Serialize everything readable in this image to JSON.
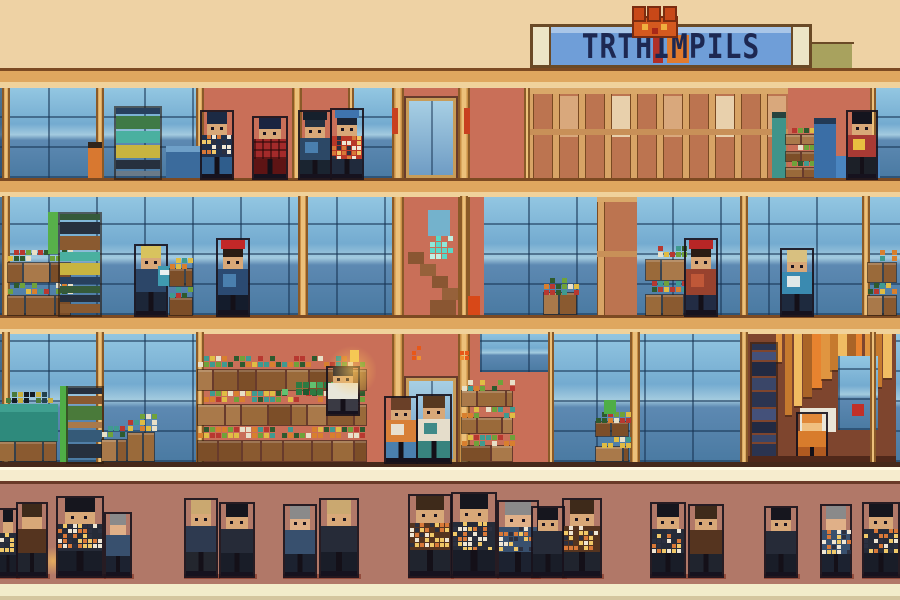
{
  "sign": {
    "text": "TRTHIMPILS"
  },
  "palette": {
    "sky": "#eed2a4",
    "wall": "#c96f58",
    "street": "#b17868",
    "sidewalk": "#f6ecce",
    "beamLine": "#7c4a22",
    "beamBody": "#dfa75f",
    "beamHi": "#f0d29b",
    "goldDark": "#8a5a28",
    "gold": "#c98f46",
    "goldHi": "#ecc07a",
    "glassLine": "rgba(23,52,84,0.55)",
    "shopBg": "#7e452e",
    "woodBase": "#bc7450",
    "signFrame": "#bd8b51",
    "signCap": "#ece5c6",
    "signBlue": "#6f9ed8",
    "signText": "#1d2852",
    "outline": "rgba(24,18,28,0.9)",
    "shadow": "rgba(122,40,24,0.55)"
  },
  "crowdPalettes": [
    {
      "hair": "#16161e",
      "skin": "#d8a878",
      "body": "#262b38",
      "legs": "#191d28"
    },
    {
      "hair": "#3e2a1a",
      "skin": "#d8a878",
      "body": "#55341f",
      "legs": "#20242e"
    },
    {
      "hair": "#8a8a8a",
      "skin": "#e0b088",
      "body": "#38506e",
      "legs": "#1c2230"
    },
    {
      "hair": "#caa870",
      "skin": "#d8a878",
      "body": "#2e3a50",
      "legs": "#23262e"
    }
  ],
  "crowd": [
    {
      "x": 0,
      "w": 16,
      "h": 66,
      "v": 0,
      "lit": 1
    },
    {
      "x": 18,
      "w": 28,
      "h": 72,
      "v": 1
    },
    {
      "x": 58,
      "w": 44,
      "h": 78,
      "v": 0,
      "lit": 1
    },
    {
      "x": 106,
      "w": 24,
      "h": 62,
      "v": 2
    },
    {
      "x": 186,
      "w": 30,
      "h": 76,
      "v": 3
    },
    {
      "x": 221,
      "w": 32,
      "h": 72,
      "v": 0
    },
    {
      "x": 285,
      "w": 30,
      "h": 70,
      "v": 2
    },
    {
      "x": 321,
      "w": 36,
      "h": 76,
      "v": 0,
      "hat": 1
    },
    {
      "x": 410,
      "w": 40,
      "h": 80,
      "v": 1,
      "lit": 1
    },
    {
      "x": 453,
      "w": 42,
      "h": 82,
      "v": 0,
      "lit": 1
    },
    {
      "x": 499,
      "w": 38,
      "h": 74,
      "v": 2,
      "lit": 1
    },
    {
      "x": 533,
      "w": 30,
      "h": 68,
      "v": 0
    },
    {
      "x": 564,
      "w": 36,
      "h": 76,
      "v": 1,
      "lit": 1
    },
    {
      "x": 652,
      "w": 32,
      "h": 72,
      "v": 0,
      "lit": 1
    },
    {
      "x": 690,
      "w": 32,
      "h": 70,
      "v": 1
    },
    {
      "x": 766,
      "w": 30,
      "h": 68,
      "v": 0
    },
    {
      "x": 822,
      "w": 28,
      "h": 70,
      "v": 2,
      "lit": 1
    },
    {
      "x": 864,
      "w": 34,
      "h": 72,
      "v": 0,
      "lit": 1
    }
  ],
  "layers": [
    {
      "k": "rect",
      "x": 745,
      "y": 42,
      "w": 109,
      "h": 2,
      "c": "#6a4a26"
    },
    {
      "k": "rect",
      "x": 747,
      "y": 44,
      "w": 48,
      "h": 24,
      "c": "#d9b069"
    },
    {
      "k": "rect",
      "x": 795,
      "y": 44,
      "w": 57,
      "h": 24,
      "c": "#a8a25e"
    },
    {
      "k": "rect",
      "x": 0,
      "y": 88,
      "w": 900,
      "h": 374,
      "c": "wall"
    },
    {
      "k": "glass",
      "x": 0,
      "y": 88,
      "w": 204,
      "h": 90
    },
    {
      "k": "glass",
      "x": 350,
      "y": 88,
      "w": 46,
      "h": 90
    },
    {
      "k": "glass",
      "x": 874,
      "y": 88,
      "w": 26,
      "h": 90
    },
    {
      "k": "glass",
      "x": 0,
      "y": 196,
      "w": 900,
      "h": 119
    },
    {
      "k": "glass",
      "x": 0,
      "y": 332,
      "w": 204,
      "h": 130
    },
    {
      "k": "glass",
      "x": 548,
      "y": 332,
      "w": 200,
      "h": 130
    },
    {
      "k": "glass",
      "x": 874,
      "y": 332,
      "w": 26,
      "h": 130
    },
    {
      "k": "glass",
      "x": 480,
      "y": 332,
      "w": 68,
      "h": 40
    },
    {
      "k": "rect",
      "x": 468,
      "y": 196,
      "w": 16,
      "h": 119,
      "c": "wall"
    },
    {
      "k": "wood",
      "x": 597,
      "y": 196,
      "w": 40,
      "h": 119
    },
    {
      "k": "wood",
      "x": 526,
      "y": 88,
      "w": 262,
      "h": 90
    },
    {
      "k": "rect",
      "x": 748,
      "y": 332,
      "w": 148,
      "h": 130,
      "c": "shopBg"
    },
    {
      "k": "strips",
      "x": 776,
      "y": 334,
      "w": 116,
      "h": 96,
      "n": 13
    },
    {
      "k": "stack",
      "x": 752,
      "y": 344,
      "w": 24,
      "h": 118,
      "pal": [
        "#2b3450",
        "#44517a",
        "#222a42",
        "#3a4668"
      ],
      "seed": 3
    },
    {
      "k": "rect",
      "x": 800,
      "y": 408,
      "w": 36,
      "h": 24,
      "c": "#eae6d8"
    },
    {
      "k": "glass",
      "x": 838,
      "y": 356,
      "w": 40,
      "h": 74
    },
    {
      "k": "rect",
      "x": 852,
      "y": 404,
      "w": 12,
      "h": 12,
      "c": "#c23028"
    },
    {
      "k": "person",
      "x": 798,
      "y": 414,
      "w": 28,
      "h": 48,
      "hair": "#e08838",
      "skin": "#f0c080",
      "body": "#d87c2c",
      "legs": "#b05a20"
    },
    {
      "k": "rect",
      "x": 748,
      "y": 456,
      "w": 148,
      "h": 6,
      "c": "#50281a"
    },
    {
      "k": "rect",
      "x": 404,
      "y": 88,
      "w": 54,
      "h": 374,
      "c": "wall"
    },
    {
      "k": "col",
      "x": 392,
      "y": 88,
      "w": 12,
      "h": 374
    },
    {
      "k": "col",
      "x": 458,
      "y": 88,
      "w": 12,
      "h": 374
    },
    {
      "k": "rect",
      "x": 392,
      "y": 108,
      "w": 6,
      "h": 26,
      "c": "#c84020"
    },
    {
      "k": "rect",
      "x": 464,
      "y": 108,
      "w": 6,
      "h": 26,
      "c": "#c84020"
    },
    {
      "k": "door",
      "x": 406,
      "y": 98,
      "w": 50,
      "h": 80
    },
    {
      "k": "rect",
      "x": 428,
      "y": 210,
      "w": 22,
      "h": 26,
      "c": "#74b2cc"
    },
    {
      "k": "pixels",
      "x": 430,
      "y": 236,
      "w": 22,
      "h": 26,
      "pal": [
        "#5ad8c8",
        "#bff0e2",
        "#2a8a7a",
        "#8ee8d8"
      ],
      "seed": 7,
      "sz": 6
    },
    {
      "k": "rect",
      "x": 408,
      "y": 252,
      "w": 16,
      "h": 12,
      "c": "#8a5632"
    },
    {
      "k": "rect",
      "x": 420,
      "y": 264,
      "w": 16,
      "h": 12,
      "c": "#96613a"
    },
    {
      "k": "rect",
      "x": 432,
      "y": 276,
      "w": 16,
      "h": 12,
      "c": "#8a5632"
    },
    {
      "k": "rect",
      "x": 442,
      "y": 288,
      "w": 16,
      "h": 12,
      "c": "#96613a"
    },
    {
      "k": "rect",
      "x": 430,
      "y": 300,
      "w": 26,
      "h": 15,
      "c": "#8a5632"
    },
    {
      "k": "door",
      "x": 406,
      "y": 378,
      "w": 50,
      "h": 84
    },
    {
      "k": "pixels",
      "x": 412,
      "y": 346,
      "w": 10,
      "h": 16,
      "pal": [
        "#f09030",
        "#e85818",
        "#f8c040"
      ],
      "seed": 11,
      "sz": 5
    },
    {
      "k": "pixels",
      "x": 460,
      "y": 346,
      "w": 10,
      "h": 16,
      "pal": [
        "#f09030",
        "#e85818",
        "#f8c040"
      ],
      "seed": 13,
      "sz": 5
    },
    {
      "k": "beam",
      "y": 68
    },
    {
      "k": "beam",
      "y": 178
    },
    {
      "k": "beam",
      "y": 315
    },
    {
      "k": "rect",
      "x": 0,
      "y": 462,
      "w": 900,
      "h": 5,
      "c": "#46291b"
    },
    {
      "k": "col",
      "x": 2,
      "y": 88,
      "w": 8,
      "h": 90
    },
    {
      "k": "col",
      "x": 96,
      "y": 88,
      "w": 8,
      "h": 90
    },
    {
      "k": "col",
      "x": 196,
      "y": 88,
      "w": 8,
      "h": 90
    },
    {
      "k": "col",
      "x": 292,
      "y": 88,
      "w": 10,
      "h": 90
    },
    {
      "k": "col",
      "x": 348,
      "y": 88,
      "w": 6,
      "h": 90
    },
    {
      "k": "col",
      "x": 524,
      "y": 88,
      "w": 6,
      "h": 90
    },
    {
      "k": "col",
      "x": 870,
      "y": 88,
      "w": 6,
      "h": 90
    },
    {
      "k": "col",
      "x": 2,
      "y": 196,
      "w": 8,
      "h": 119
    },
    {
      "k": "col",
      "x": 298,
      "y": 196,
      "w": 10,
      "h": 119
    },
    {
      "k": "col",
      "x": 460,
      "y": 196,
      "w": 8,
      "h": 119
    },
    {
      "k": "col",
      "x": 740,
      "y": 196,
      "w": 8,
      "h": 119
    },
    {
      "k": "col",
      "x": 862,
      "y": 196,
      "w": 8,
      "h": 119
    },
    {
      "k": "col",
      "x": 2,
      "y": 332,
      "w": 8,
      "h": 130
    },
    {
      "k": "col",
      "x": 96,
      "y": 332,
      "w": 8,
      "h": 130
    },
    {
      "k": "col",
      "x": 196,
      "y": 332,
      "w": 8,
      "h": 130
    },
    {
      "k": "col",
      "x": 548,
      "y": 332,
      "w": 6,
      "h": 130
    },
    {
      "k": "col",
      "x": 630,
      "y": 332,
      "w": 10,
      "h": 130
    },
    {
      "k": "col",
      "x": 740,
      "y": 332,
      "w": 8,
      "h": 130
    },
    {
      "k": "col",
      "x": 870,
      "y": 332,
      "w": 6,
      "h": 130
    },
    {
      "k": "stack",
      "x": 116,
      "y": 108,
      "w": 44,
      "h": 70,
      "pal": [
        "#27405e",
        "#3f7a46",
        "#4ab0a0",
        "#c8b440",
        "#26303e",
        "#6a7a88",
        "#355a78"
      ],
      "seed": 21
    },
    {
      "k": "rect",
      "x": 88,
      "y": 142,
      "w": 14,
      "h": 6,
      "c": "#30241c"
    },
    {
      "k": "rect",
      "x": 88,
      "y": 148,
      "w": 14,
      "h": 30,
      "c": "#d87830"
    },
    {
      "k": "rect",
      "x": 166,
      "y": 146,
      "w": 38,
      "h": 6,
      "c": "#6fa0c8"
    },
    {
      "k": "rect",
      "x": 166,
      "y": 152,
      "w": 38,
      "h": 26,
      "c": "#3b6b9c"
    },
    {
      "k": "person",
      "x": 202,
      "y": 112,
      "w": 30,
      "h": 66,
      "hair": "#1c2a44",
      "skin": "#d8a878",
      "body": "#20304c",
      "legs": "#2f5d8c",
      "lit": 1,
      "eyes": 1
    },
    {
      "k": "person",
      "x": 254,
      "y": 118,
      "w": 32,
      "h": 60,
      "hair": "#1a2440",
      "skin": "#d8a878",
      "body": "#a32a2a",
      "legs": "#5e1414",
      "plaid": 1,
      "eyes": 1
    },
    {
      "k": "person",
      "x": 300,
      "y": 112,
      "w": 30,
      "h": 66,
      "hat": "#16202c",
      "hair": "#222f40",
      "skin": "#d8a878",
      "body": "#2c4866",
      "legs": "#1a2430",
      "patch": "#4a7fae",
      "eyes": 1
    },
    {
      "k": "person",
      "x": 332,
      "y": 110,
      "w": 30,
      "h": 68,
      "hat": "#3f74ae",
      "hair": "#1c2434",
      "skin": "#d8a878",
      "body": "#b83828",
      "legs": "#202a3c",
      "lit": 1,
      "eyes": 1
    },
    {
      "k": "rect",
      "x": 772,
      "y": 112,
      "w": 14,
      "h": 6,
      "c": "#26433e"
    },
    {
      "k": "rect",
      "x": 772,
      "y": 118,
      "w": 14,
      "h": 60,
      "c": "#3f948a"
    },
    {
      "k": "crates",
      "x": 786,
      "y": 128,
      "w": 30,
      "h": 50,
      "rows": 3,
      "seed": 31
    },
    {
      "k": "rect",
      "x": 814,
      "y": 118,
      "w": 22,
      "h": 6,
      "c": "#223a56"
    },
    {
      "k": "rect",
      "x": 814,
      "y": 124,
      "w": 22,
      "h": 54,
      "c": "#3a6ea6"
    },
    {
      "k": "rect",
      "x": 836,
      "y": 156,
      "w": 44,
      "h": 22,
      "c": "#4a85c0"
    },
    {
      "k": "person",
      "x": 848,
      "y": 112,
      "w": 28,
      "h": 66,
      "hair": "#14141e",
      "skin": "#d8a878",
      "body": "#a83a34",
      "legs": "#1c2028",
      "patch": "#e8c040",
      "eyes": 1
    },
    {
      "k": "crates",
      "x": 8,
      "y": 250,
      "w": 64,
      "h": 65,
      "rows": 2,
      "seed": 41
    },
    {
      "k": "rect",
      "x": 48,
      "y": 212,
      "w": 10,
      "h": 42,
      "c": "#57b04a"
    },
    {
      "k": "stack",
      "x": 60,
      "y": 214,
      "w": 40,
      "h": 101,
      "pal": [
        "#355a3a",
        "#26303e",
        "#8a5a30",
        "#4ab0a0",
        "#c8b440",
        "#27405e"
      ],
      "seed": 43
    },
    {
      "k": "person",
      "x": 136,
      "y": 246,
      "w": 30,
      "h": 69,
      "hair": "#d8c35e",
      "skin": "#d8a878",
      "body": "#2c4668",
      "legs": "#1c2638",
      "eyes": 1
    },
    {
      "k": "rect",
      "x": 158,
      "y": 266,
      "w": 16,
      "h": 20,
      "c": "#3f9ab0"
    },
    {
      "k": "rect",
      "x": 160,
      "y": 270,
      "w": 12,
      "h": 5,
      "c": "#e8f0f0"
    },
    {
      "k": "crates",
      "x": 170,
      "y": 258,
      "w": 24,
      "h": 57,
      "rows": 2,
      "seed": 47
    },
    {
      "k": "person",
      "x": 218,
      "y": 240,
      "w": 30,
      "h": 75,
      "hat": "#c22828",
      "hair": "#2a1c14",
      "skin": "#d8a878",
      "body": "#2b4a72",
      "legs": "#141c2c",
      "patch": "#4a7fae",
      "eyes": 1
    },
    {
      "k": "rect",
      "x": 468,
      "y": 296,
      "w": 12,
      "h": 19,
      "c": "#d84818"
    },
    {
      "k": "crates",
      "x": 544,
      "y": 278,
      "w": 34,
      "h": 37,
      "rows": 1,
      "seed": 53
    },
    {
      "k": "crates",
      "x": 646,
      "y": 246,
      "w": 40,
      "h": 69,
      "rows": 2,
      "seed": 59
    },
    {
      "k": "person",
      "x": 686,
      "y": 240,
      "w": 30,
      "h": 75,
      "hat": "#b82626",
      "hair": "#2a1c14",
      "skin": "#d8a878",
      "body": "#98422e",
      "legs": "#222c44",
      "patch": "#c05838",
      "eyes": 1
    },
    {
      "k": "person",
      "x": 782,
      "y": 250,
      "w": 30,
      "h": 65,
      "hair": "#d8c080",
      "skin": "#d8a878",
      "body": "#3a8ab0",
      "legs": "#1e2a3e",
      "patch": "#e0e8e8",
      "eyes": 1
    },
    {
      "k": "crates",
      "x": 868,
      "y": 250,
      "w": 30,
      "h": 65,
      "rows": 2,
      "seed": 61
    },
    {
      "k": "pixels",
      "x": 6,
      "y": 392,
      "w": 46,
      "h": 12,
      "pal": [
        "#24424e",
        "#4a7a3a",
        "#141c24",
        "#c8b040"
      ],
      "seed": 67,
      "sz": 6
    },
    {
      "k": "rect",
      "x": 0,
      "y": 404,
      "w": 58,
      "h": 8,
      "c": "#3fa090"
    },
    {
      "k": "rect",
      "x": 0,
      "y": 412,
      "w": 58,
      "h": 30,
      "c": "#2e8a7c"
    },
    {
      "k": "crates",
      "x": 0,
      "y": 442,
      "w": 58,
      "h": 20,
      "rows": 1,
      "seed": 71,
      "plain": 1
    },
    {
      "k": "rect",
      "x": 60,
      "y": 386,
      "w": 8,
      "h": 76,
      "c": "#4fae46"
    },
    {
      "k": "stack",
      "x": 68,
      "y": 388,
      "w": 34,
      "h": 74,
      "pal": [
        "#26303e",
        "#8a5a30",
        "#4a7a3a",
        "#a9794a",
        "#355a78"
      ],
      "seed": 73
    },
    {
      "k": "crates",
      "x": 102,
      "y": 426,
      "w": 26,
      "h": 36,
      "rows": 1,
      "seed": 79
    },
    {
      "k": "crates",
      "x": 128,
      "y": 414,
      "w": 28,
      "h": 48,
      "rows": 1,
      "seed": 83
    },
    {
      "k": "crates",
      "x": 198,
      "y": 356,
      "w": 170,
      "h": 106,
      "rows": 3,
      "seed": 89
    },
    {
      "k": "pixels",
      "x": 282,
      "y": 382,
      "w": 52,
      "h": 14,
      "pal": [
        "#3f9a58",
        "#2e7a42",
        "#62c070",
        "#1e5a30"
      ],
      "seed": 97,
      "sz": 7
    },
    {
      "k": "person",
      "x": 328,
      "y": 368,
      "w": 30,
      "h": 46,
      "hair": "#23232d",
      "skin": "#d8a878",
      "body": "#e8e6da",
      "legs": "#3a3a44",
      "eyes": 1
    },
    {
      "k": "glow",
      "x": 328,
      "y": 344,
      "w": 48,
      "h": 54
    },
    {
      "k": "rect",
      "x": 350,
      "y": 350,
      "w": 9,
      "h": 12,
      "c": "#f5c854"
    },
    {
      "k": "person",
      "x": 386,
      "y": 398,
      "w": 30,
      "h": 64,
      "hair": "#6a4028",
      "skin": "#d8a878",
      "body": "#d88038",
      "legs": "#4a7fae",
      "patch": "#e8e0d0",
      "eyes": 1
    },
    {
      "k": "person",
      "x": 418,
      "y": 396,
      "w": 32,
      "h": 66,
      "hair": "#57381f",
      "skin": "#d8a878",
      "body": "#e5ddcb",
      "legs": "#38837e",
      "patch": "#3f8a88",
      "eyes": 1
    },
    {
      "k": "crates",
      "x": 462,
      "y": 380,
      "w": 52,
      "h": 82,
      "rows": 3,
      "seed": 101
    },
    {
      "k": "crates",
      "x": 596,
      "y": 412,
      "w": 34,
      "h": 50,
      "rows": 2,
      "seed": 103
    },
    {
      "k": "rect",
      "x": 604,
      "y": 400,
      "w": 12,
      "h": 14,
      "c": "#4fae46"
    },
    {
      "k": "rect",
      "x": 0,
      "y": 467,
      "w": 900,
      "h": 14,
      "c": "sidewalk"
    },
    {
      "k": "rect",
      "x": 0,
      "y": 467,
      "w": 900,
      "h": 3,
      "c": "#fff8e2"
    },
    {
      "k": "rect",
      "x": 0,
      "y": 481,
      "w": 900,
      "h": 3,
      "c": "#6a3a28"
    },
    {
      "k": "rect",
      "x": 0,
      "y": 484,
      "w": 900,
      "h": 100,
      "c": "street"
    },
    {
      "k": "rect",
      "x": 0,
      "y": 584,
      "w": 900,
      "h": 12,
      "c": "#f2ecca"
    },
    {
      "k": "rect",
      "x": 0,
      "y": 596,
      "w": 900,
      "h": 4,
      "c": "#d4c69e"
    },
    {
      "k": "glow",
      "x": 42,
      "y": 544,
      "w": 22,
      "h": 34
    }
  ]
}
